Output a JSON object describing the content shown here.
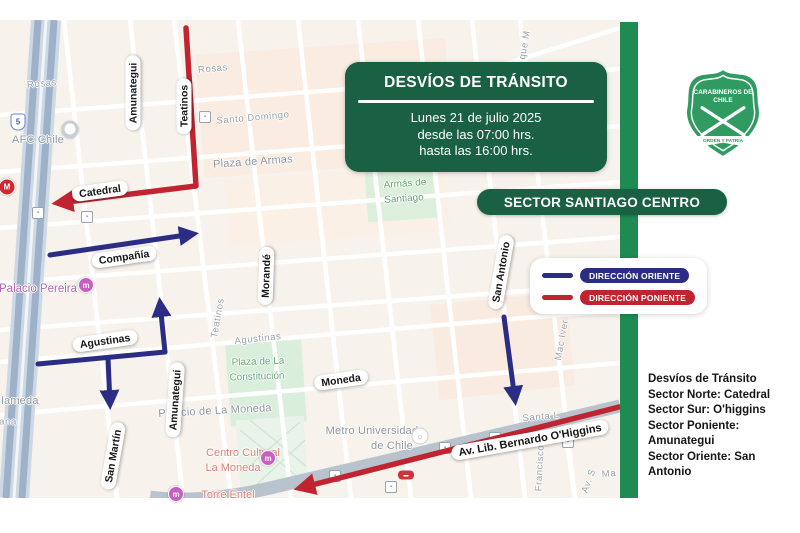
{
  "title_box": {
    "title": "DESVÍOS DE TRÁNSITO",
    "line1": "Lunes 21 de julio 2025",
    "line2": "desde las 07:00 hrs.",
    "line3": "hasta las 16:00 hrs."
  },
  "sector_banner": {
    "label": "SECTOR SANTIAGO CENTRO"
  },
  "legend": {
    "oriente_label": "DIRECCIÓN ORIENTE",
    "poniente_label": "DIRECCIÓN PONIENTE"
  },
  "detour_list": {
    "title": "Desvíos de Tránsito",
    "items": [
      "Sector Norte: Catedral",
      "Sector Sur: O'higgins",
      "Sector Poniente: Amunategui",
      "Sector Oriente: San Antonio"
    ]
  },
  "logo": {
    "org_line1": "CARABINEROS DE",
    "org_line2": "CHILE",
    "motto": "ORDEN Y PATRIA"
  },
  "colors": {
    "dark_green": "#1a6144",
    "bar_green": "#1e8c52",
    "navy": "#2b2d84",
    "red": "#bf2430"
  },
  "map": {
    "street_pills": [
      {
        "text": "Amunategui",
        "x": 133,
        "y": 93,
        "rot": -90
      },
      {
        "text": "Teatinos",
        "x": 184,
        "y": 106,
        "rot": -90
      },
      {
        "text": "Catedral",
        "x": 100,
        "y": 191,
        "rot": -8
      },
      {
        "text": "Compañía",
        "x": 124,
        "y": 257,
        "rot": -8
      },
      {
        "text": "Morandé",
        "x": 266,
        "y": 276,
        "rot": -88
      },
      {
        "text": "Agustinas",
        "x": 105,
        "y": 341,
        "rot": -8
      },
      {
        "text": "Moneda",
        "x": 341,
        "y": 380,
        "rot": -8
      },
      {
        "text": "Amunategui",
        "x": 175,
        "y": 400,
        "rot": -86
      },
      {
        "text": "San Martín",
        "x": 113,
        "y": 456,
        "rot": -80
      },
      {
        "text": "San Antonio",
        "x": 501,
        "y": 272,
        "rot": -80
      },
      {
        "text": "Av. Lib. Bernardo O'Higgins",
        "x": 530,
        "y": 440,
        "rot": -10,
        "lg": true
      }
    ],
    "labels": [
      {
        "text": "Rosas",
        "x": 42,
        "y": 84,
        "rot": -5,
        "cls": "gray"
      },
      {
        "text": "Rosas",
        "x": 213,
        "y": 69,
        "rot": -5,
        "cls": "gray"
      },
      {
        "text": "AFC Chile",
        "x": 38,
        "y": 140,
        "rot": 0,
        "cls": "gray-lg"
      },
      {
        "text": "Santo Domingo",
        "x": 253,
        "y": 118,
        "rot": -5,
        "cls": "gray"
      },
      {
        "text": "Plaza de Armas",
        "x": 253,
        "y": 162,
        "rot": -4,
        "cls": "gray-lg"
      },
      {
        "text": "Armás de",
        "x": 405,
        "y": 184,
        "rot": -4,
        "cls": "green"
      },
      {
        "text": "Santiago",
        "x": 404,
        "y": 199,
        "rot": -4,
        "cls": "green"
      },
      {
        "text": "que M",
        "x": 525,
        "y": 45,
        "rot": -80,
        "cls": "gray"
      },
      {
        "text": "Teatinos",
        "x": 218,
        "y": 318,
        "rot": -80,
        "cls": "gray"
      },
      {
        "text": "Agustinas",
        "x": 258,
        "y": 339,
        "rot": -6,
        "cls": "gray"
      },
      {
        "text": "Plaza de La",
        "x": 258,
        "y": 362,
        "rot": -2,
        "cls": "green"
      },
      {
        "text": "Constitución",
        "x": 257,
        "y": 377,
        "rot": -2,
        "cls": "green"
      },
      {
        "text": "Palacio de La Moneda",
        "x": 215,
        "y": 411,
        "rot": -3,
        "cls": "gray-lg"
      },
      {
        "text": "Metro Universidad",
        "x": 372,
        "y": 431,
        "rot": 0,
        "cls": "gray-lg"
      },
      {
        "text": "de Chile",
        "x": 392,
        "y": 446,
        "rot": 0,
        "cls": "gray-lg"
      },
      {
        "text": "Centro Cultural",
        "x": 243,
        "y": 453,
        "rot": 0,
        "cls": "coral"
      },
      {
        "text": "La Moneda",
        "x": 233,
        "y": 468,
        "rot": 0,
        "cls": "coral"
      },
      {
        "text": "Torre Entel",
        "x": 228,
        "y": 495,
        "rot": 0,
        "cls": "coral"
      },
      {
        "text": "Palacio Pereira",
        "x": 38,
        "y": 289,
        "rot": 0,
        "cls": "purple"
      },
      {
        "text": "lameda",
        "x": 20,
        "y": 401,
        "rot": 0,
        "cls": "gray-lg"
      },
      {
        "text": "ana",
        "x": 8,
        "y": 422,
        "rot": 0,
        "cls": "gray"
      },
      {
        "text": "Mac Iver",
        "x": 562,
        "y": 340,
        "rot": -80,
        "cls": "gray"
      },
      {
        "text": "Santa L",
        "x": 541,
        "y": 417,
        "rot": -5,
        "cls": "gray"
      },
      {
        "text": "Francisco",
        "x": 540,
        "y": 468,
        "rot": -87,
        "cls": "gray"
      },
      {
        "text": "Av. S",
        "x": 589,
        "y": 481,
        "rot": -70,
        "cls": "gray"
      },
      {
        "text": "Ma",
        "x": 609,
        "y": 474,
        "rot": -5,
        "cls": "gray"
      }
    ],
    "icons": [
      {
        "type": "shield5",
        "x": 18,
        "y": 122
      },
      {
        "type": "metro-red",
        "x": 7,
        "y": 187
      },
      {
        "type": "pin",
        "x": 70,
        "y": 129
      },
      {
        "type": "transit",
        "x": 205,
        "y": 117
      },
      {
        "type": "transit",
        "x": 38,
        "y": 213
      },
      {
        "type": "transit",
        "x": 87,
        "y": 217
      },
      {
        "type": "plaza-red",
        "x": 363,
        "y": 162
      },
      {
        "type": "metro-pink",
        "x": 86,
        "y": 285
      },
      {
        "type": "metro-pink",
        "x": 268,
        "y": 458
      },
      {
        "type": "metro-pink",
        "x": 176,
        "y": 494
      },
      {
        "type": "metro-white",
        "x": 420,
        "y": 436
      },
      {
        "type": "transit",
        "x": 335,
        "y": 476
      },
      {
        "type": "transit",
        "x": 391,
        "y": 487
      },
      {
        "type": "transit",
        "x": 445,
        "y": 448
      },
      {
        "type": "rail-red",
        "x": 406,
        "y": 475
      },
      {
        "type": "transit",
        "x": 495,
        "y": 438
      },
      {
        "type": "transit",
        "x": 568,
        "y": 442
      }
    ]
  }
}
